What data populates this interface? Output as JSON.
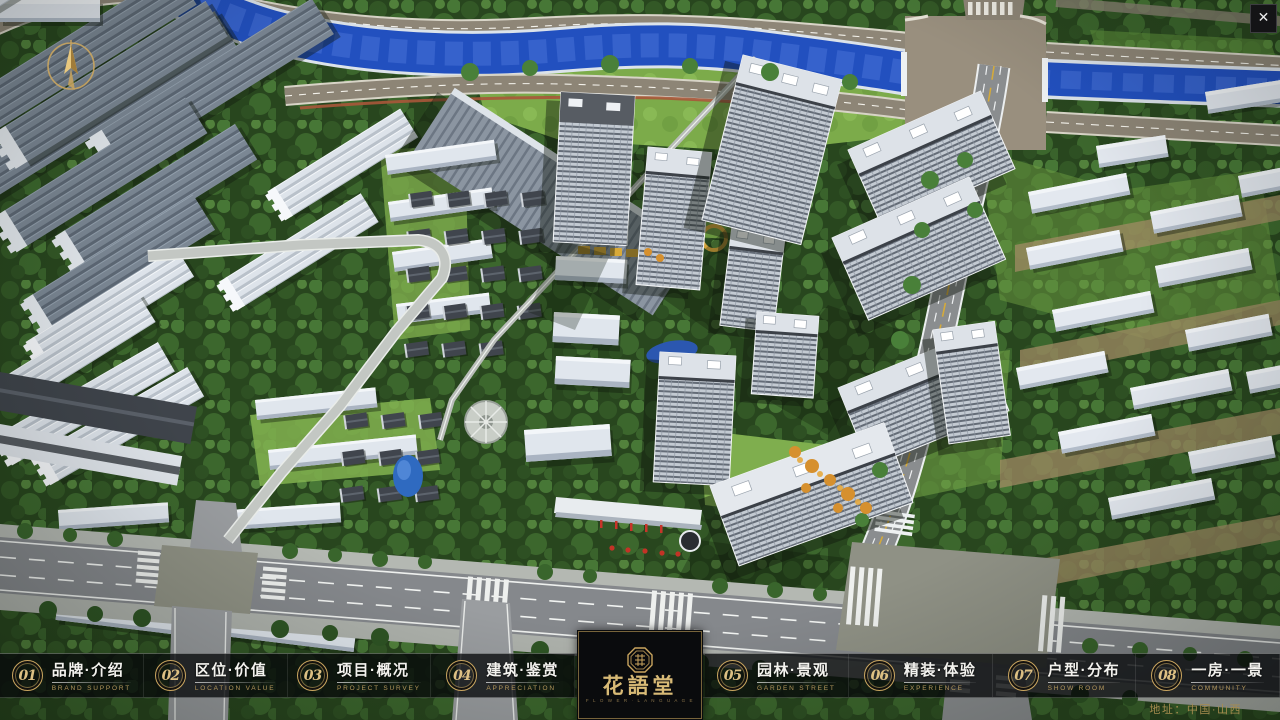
{
  "window": {
    "close_glyph": "✕"
  },
  "logo": {
    "title": "花語堂",
    "subtitle": "F L O W E R · L A N G U A G E"
  },
  "footer": {
    "address": "地址：中国·山西"
  },
  "nav": {
    "items": [
      {
        "number": "01",
        "label": "品牌·介绍",
        "sublabel": "BRAND SUPPORT"
      },
      {
        "number": "02",
        "label": "区位·价值",
        "sublabel": "LOCATION VALUE"
      },
      {
        "number": "03",
        "label": "项目·概况",
        "sublabel": "PROJECT SURVEY"
      },
      {
        "number": "04",
        "label": "建筑·鉴赏",
        "sublabel": "APPRECIATION"
      },
      {
        "number": "05",
        "label": "园林·景观",
        "sublabel": "GARDEN STREET"
      },
      {
        "number": "06",
        "label": "精装·体验",
        "sublabel": "EXPERIENCE"
      },
      {
        "number": "07",
        "label": "户型·分布",
        "sublabel": "SHOW ROOM"
      },
      {
        "number": "08",
        "label": "一房·一景",
        "sublabel": "COMMUNITY"
      }
    ]
  },
  "colors": {
    "gold": "#c9a55f",
    "gold_text": "#d8ba76",
    "bar_background": "#0b0c0e",
    "river_blue": "#2250bf",
    "forest_green": "#3c672d",
    "lawn_green": "#7cab4a",
    "road_grey": "#85888c",
    "plaza_tan": "#998f7e",
    "tower_white": "#dde2e8"
  }
}
